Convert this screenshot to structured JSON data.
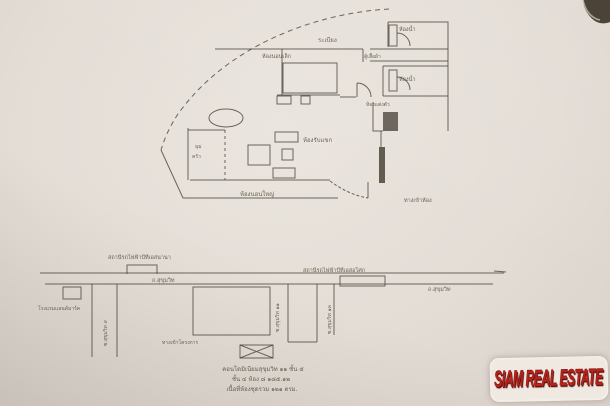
{
  "floor_plan": {
    "labels": {
      "balcony": "ระเบียง",
      "bedroom2": "ห้องนอนเล็ก",
      "bathroom_top": "ห้องน้ำ",
      "wardrobe": "ตู้เสื้อผ้า",
      "bathroom_mid": "ห้องน้ำ",
      "dressing_room": "ห้องแต่งตัว",
      "living_room": "ห้องรับแขก",
      "kitchen_line1": "มุม",
      "kitchen_line2": "ครัว",
      "master_bedroom": "ห้องนอนใหญ่",
      "entrance": "ทางเข้าห้อง"
    }
  },
  "map": {
    "labels": {
      "station_left": "สถานีรถไฟฟ้าบีทีเอสนานา",
      "station_right": "สถานีรถไฟฟ้าบีทีเอสอโศก",
      "road_left": "ถ.สุขุมวิท",
      "road_right": "ถ.สุขุมวิท",
      "landmark_left": "โรงแรมแลนด์มาร์ค",
      "soi_left": "ซ.สุขุมวิท ๙",
      "soi_mid": "ซ.สุขุมวิท ๑๑",
      "soi_right": "ซ.สุขุมวิท ๑๓",
      "lane_bottom": "ทางเข้าโครงการ"
    },
    "caption": {
      "line1": "คอนโดมิเนียมสุขุมวิท ๑๑ ชั้น ๕",
      "line2": "ชั้น ๔ ห้อง ๘ ๑๘๕.๑๒",
      "line3": "เนื้อที่ห้องชุดรวม ๑๒๑ ตรม."
    }
  },
  "watermark": {
    "text": "SIAM REAL ESTATE",
    "color": "#b5231d"
  },
  "colors": {
    "paper": "#e4ddd6",
    "ink": "#4a443b"
  }
}
